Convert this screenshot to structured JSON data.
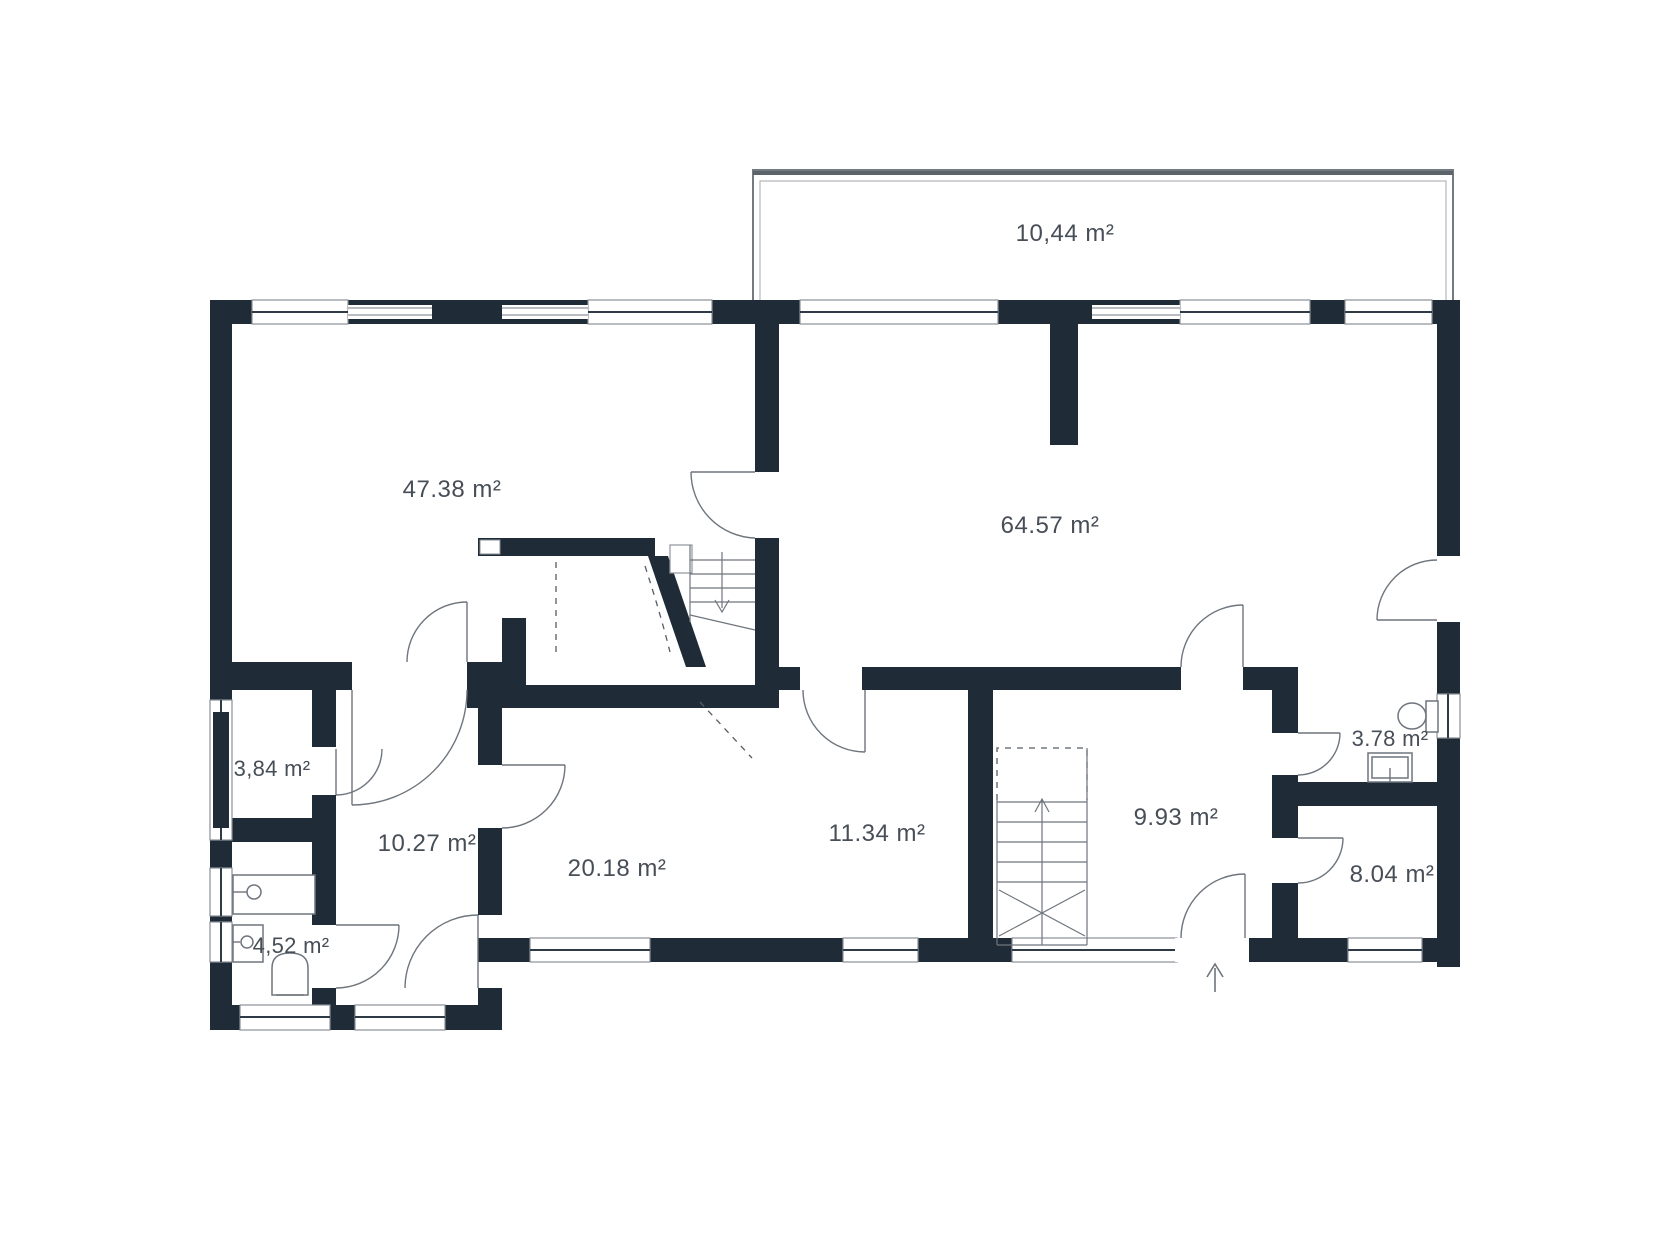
{
  "plan": {
    "title": "floor-plan",
    "unit": "m²",
    "colors": {
      "wall": "#1f2b37",
      "thin_line": "#8f959c",
      "door_line": "#6e757d",
      "text": "#474e57",
      "background": "#ffffff"
    },
    "rooms": [
      {
        "id": "balcony",
        "label": "10,44 m²"
      },
      {
        "id": "living-room",
        "label": "47.38 m²"
      },
      {
        "id": "living-kitchen",
        "label": "64.57 m²"
      },
      {
        "id": "storage",
        "label": "3,84 m²"
      },
      {
        "id": "hallway",
        "label": "10.27 m²"
      },
      {
        "id": "bedroom",
        "label": "20.18 m²"
      },
      {
        "id": "middle-room",
        "label": "11.34 m²"
      },
      {
        "id": "entry-hall",
        "label": "9.93 m²"
      },
      {
        "id": "wc",
        "label": "3.78 m²"
      },
      {
        "id": "rear-room",
        "label": "8.04 m²"
      },
      {
        "id": "bathroom",
        "label": "4,52 m²"
      }
    ],
    "icons": [
      "stairs-down-icon",
      "stairs-up-icon",
      "entry-arrow-icon",
      "toilet-icon",
      "sink-icon",
      "vanity-icon",
      "wc-sink-icon",
      "wc-toilet-icon",
      "bed-dashed-outline",
      "radiator-strip"
    ]
  }
}
